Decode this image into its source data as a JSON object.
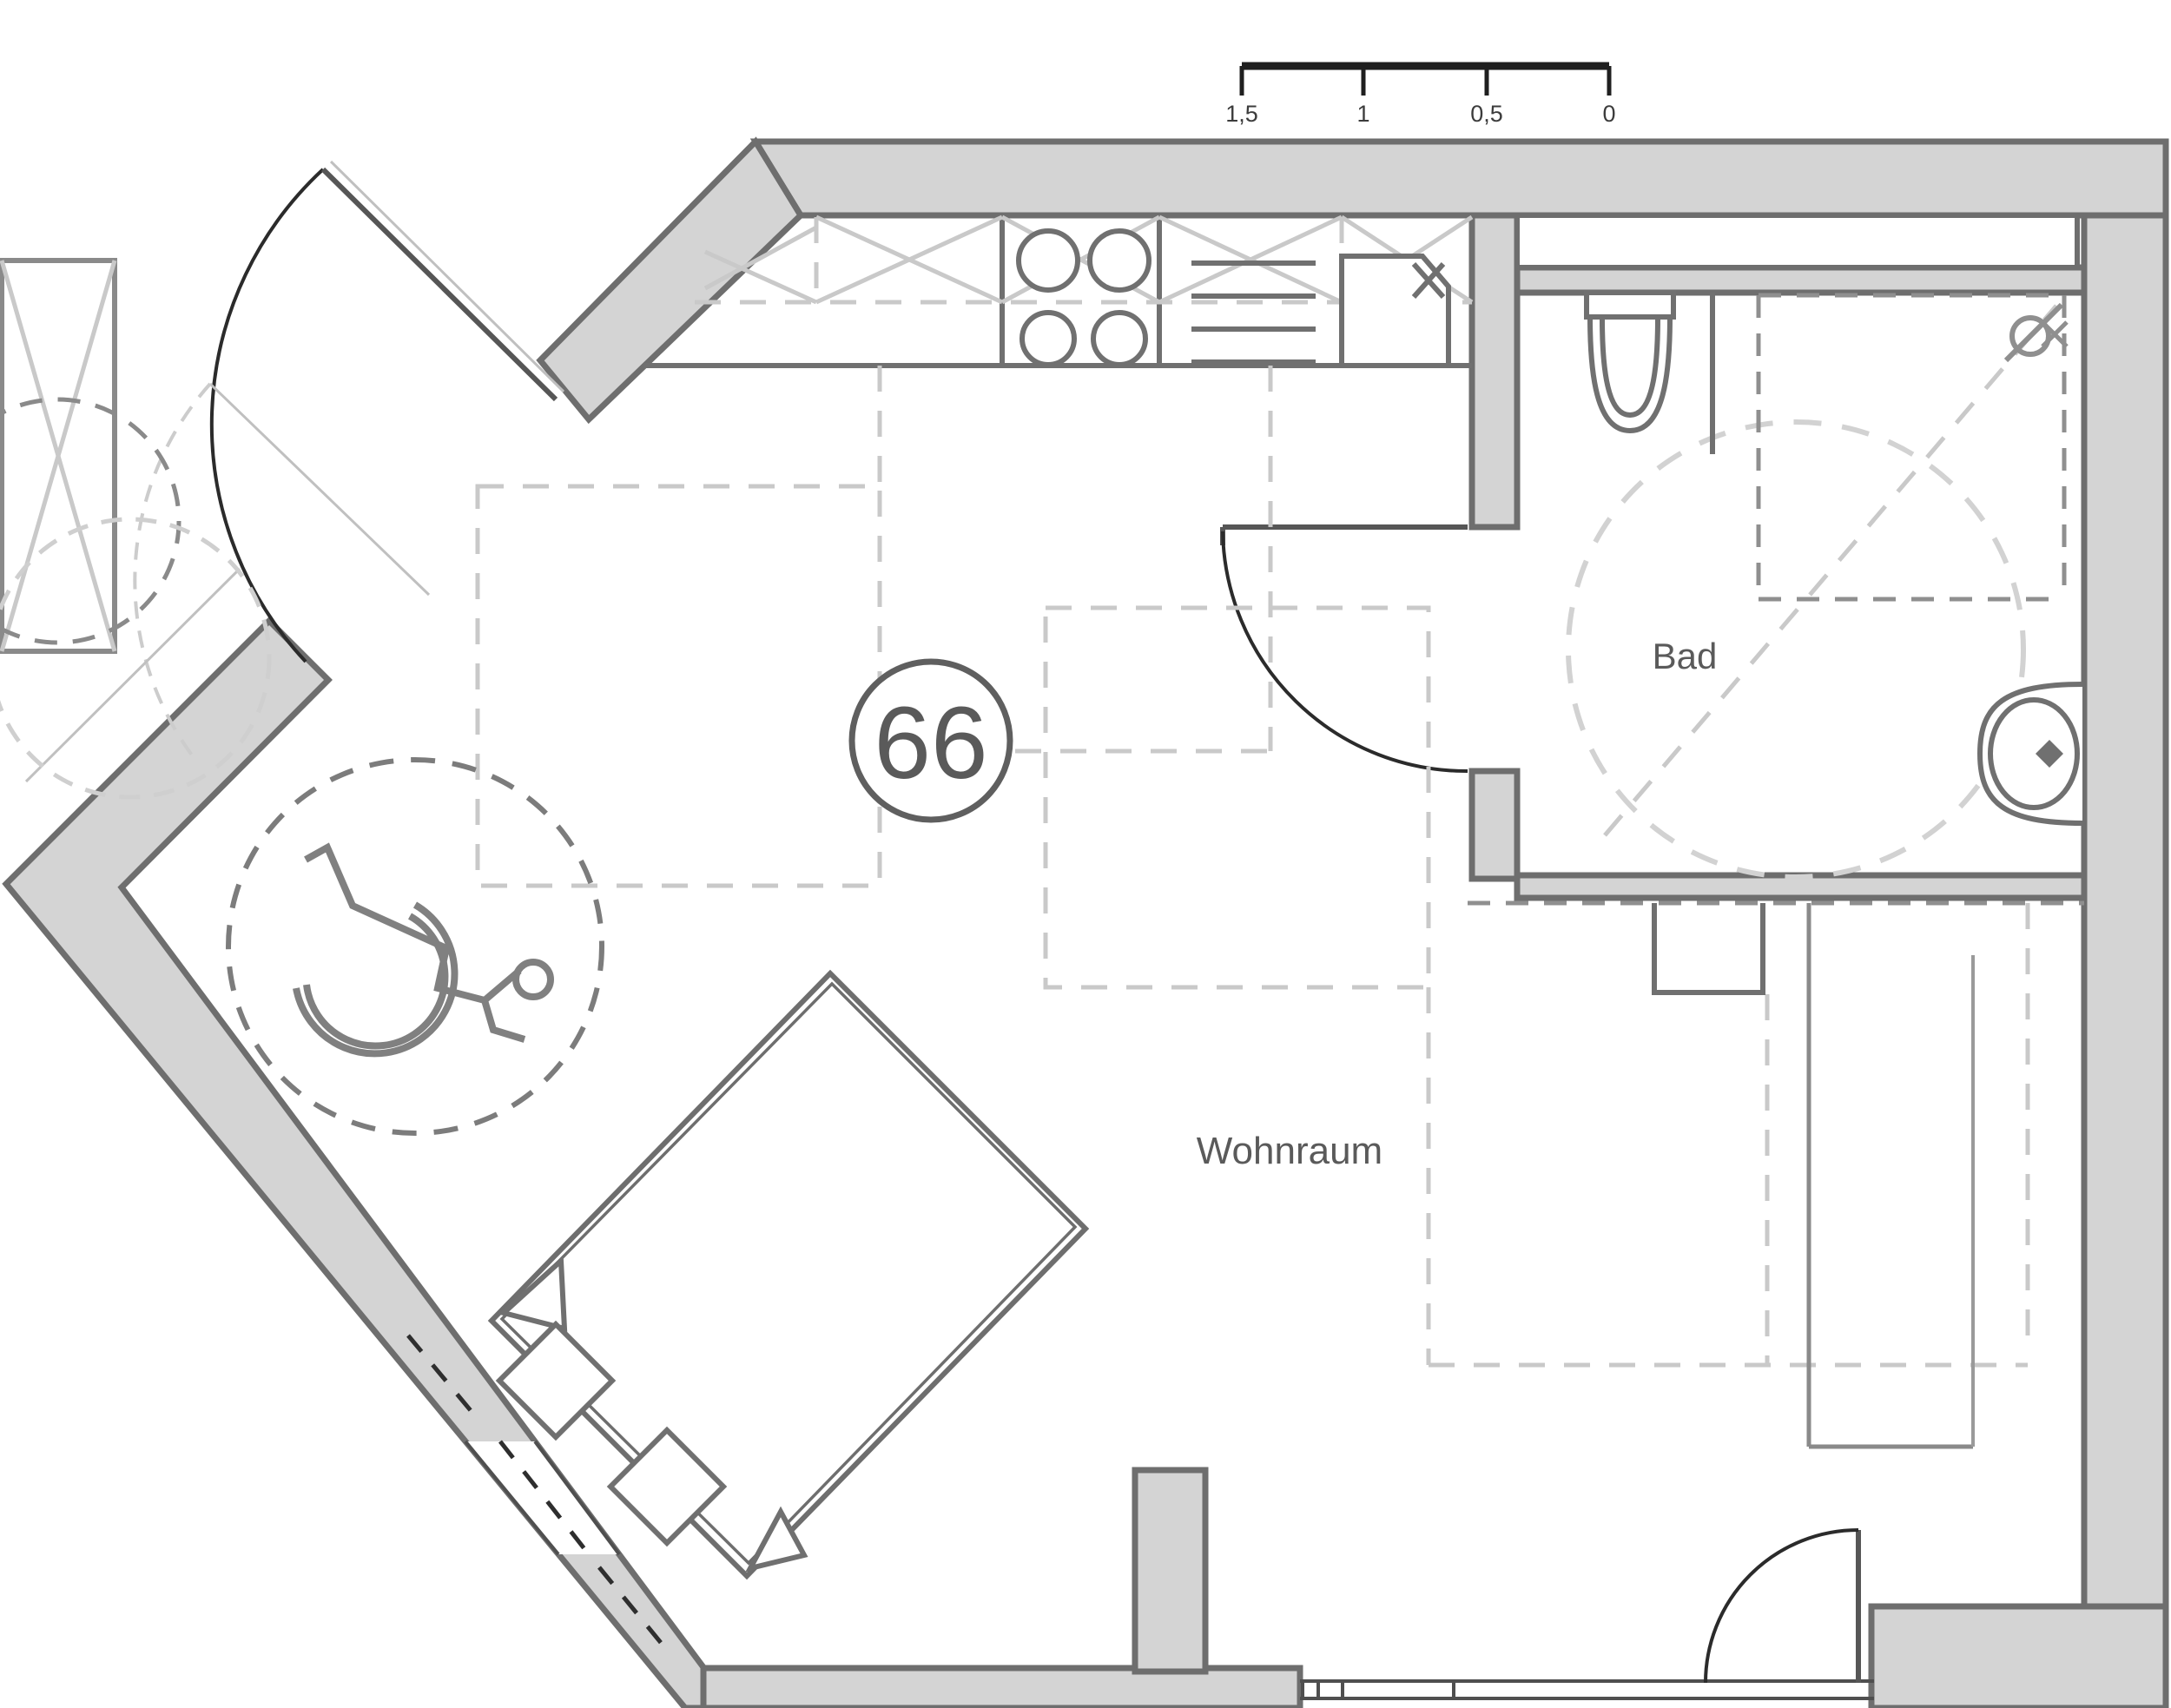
{
  "document": {
    "type": "floor-plan",
    "description": "Barrier-free apartment floor plan, unit 66, with kitchen strip, bathroom and living room"
  },
  "scale_bar": {
    "labels": [
      "1,5",
      "1",
      "0,5",
      "0"
    ],
    "unit_interval_m": 0.5
  },
  "unit": {
    "number": "66"
  },
  "rooms": {
    "bad": "Bad",
    "wohnraum": "Wohnraum"
  },
  "icons": {
    "wheelchair": "wheelchair-turning-area-symbol",
    "shower": "shower-head-symbol",
    "toilet": "wall-hung-wc-symbol",
    "washbasin": "washbasin-symbol",
    "hob": "four-plate-cooktop-symbol",
    "sink": "kitchen-sink-symbol",
    "dishwasher": "dishwasher-symbol"
  },
  "colors": {
    "wall_fill": "#d4d4d4",
    "wall_edge": "#6e6e6e",
    "fixture": "#707070",
    "light_dash": "#c9c9c9",
    "dark_dash": "#8f8f8f",
    "door_arc": "#2b2b2b",
    "text": "#5a5a5a",
    "scale_bar": "#1f1f1f"
  }
}
